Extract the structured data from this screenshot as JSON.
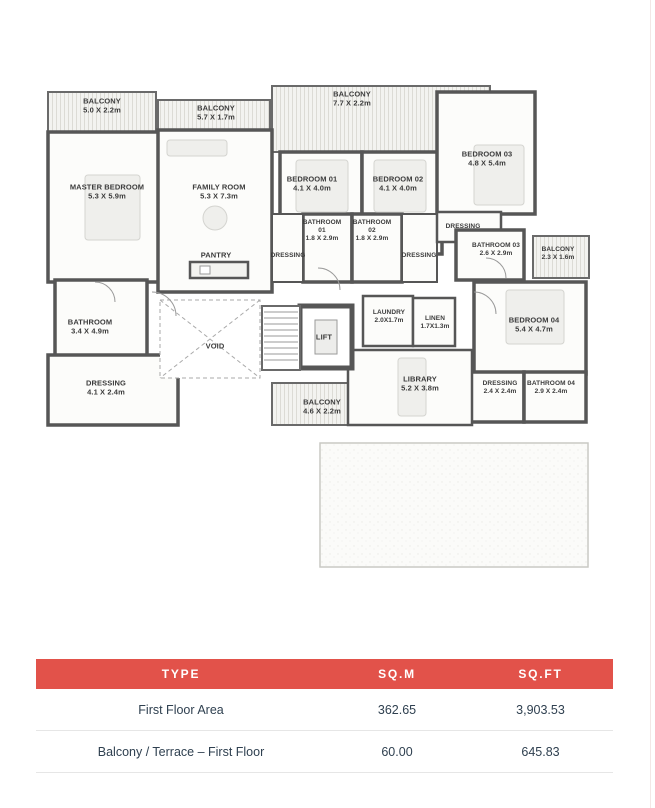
{
  "plan": {
    "rooms": [
      {
        "name": "BALCONY",
        "dims": "5.0 X 2.2m"
      },
      {
        "name": "BALCONY",
        "dims": "5.7 X 1.7m"
      },
      {
        "name": "BALCONY",
        "dims": "7.7 X 2.2m"
      },
      {
        "name": "MASTER BEDROOM",
        "dims": "5.3 X 5.9m"
      },
      {
        "name": "FAMILY ROOM",
        "dims": "5.3 X 7.3m"
      },
      {
        "name": "BEDROOM 01",
        "dims": "4.1 X 4.0m"
      },
      {
        "name": "BEDROOM 02",
        "dims": "4.1 X 4.0m"
      },
      {
        "name": "BEDROOM 03",
        "dims": "4.8 X 5.4m"
      },
      {
        "name": "BATHROOM",
        "sub": "01",
        "dims": "1.8 X 2.9m"
      },
      {
        "name": "BATHROOM",
        "sub": "02",
        "dims": "1.8 X 2.9m"
      },
      {
        "name": "DRESSING"
      },
      {
        "name": "DRESSING"
      },
      {
        "name": "PANTRY"
      },
      {
        "name": "DRESSING"
      },
      {
        "name": "BATHROOM 03",
        "dims": "2.6 X 2.9m"
      },
      {
        "name": "BALCONY",
        "dims": "2.3 X 1.6m"
      },
      {
        "name": "BATHROOM",
        "dims": "3.4 X 4.9m"
      },
      {
        "name": "DRESSING",
        "dims": "4.1 X 2.4m"
      },
      {
        "name": "VOID"
      },
      {
        "name": "LIFT"
      },
      {
        "name": "LAUNDRY",
        "dims": "2.0X1.7m"
      },
      {
        "name": "LINEN",
        "dims": "1.7X1.3m"
      },
      {
        "name": "LIBRARY",
        "dims": "5.2 X 3.8m"
      },
      {
        "name": "BALCONY",
        "dims": "4.6 X 2.2m"
      },
      {
        "name": "BEDROOM 04",
        "dims": "5.4 X 4.7m"
      },
      {
        "name": "DRESSING",
        "dims": "2.4 X 2.4m"
      },
      {
        "name": "BATHROOM 04",
        "dims": "2.9 X 2.4m"
      }
    ]
  },
  "table": {
    "columns": [
      "TYPE",
      "SQ.M",
      "SQ.FT"
    ],
    "rows": [
      {
        "type": "First Floor Area",
        "sqm": "362.65",
        "sqft": "3,903.53"
      },
      {
        "type": "Balcony / Terrace – First Floor",
        "sqm": "60.00",
        "sqft": "645.83"
      }
    ]
  },
  "colors": {
    "header_bg": "#e2524a",
    "header_text": "#ffffff",
    "row_text": "#2f4050",
    "wall": "#565656"
  }
}
